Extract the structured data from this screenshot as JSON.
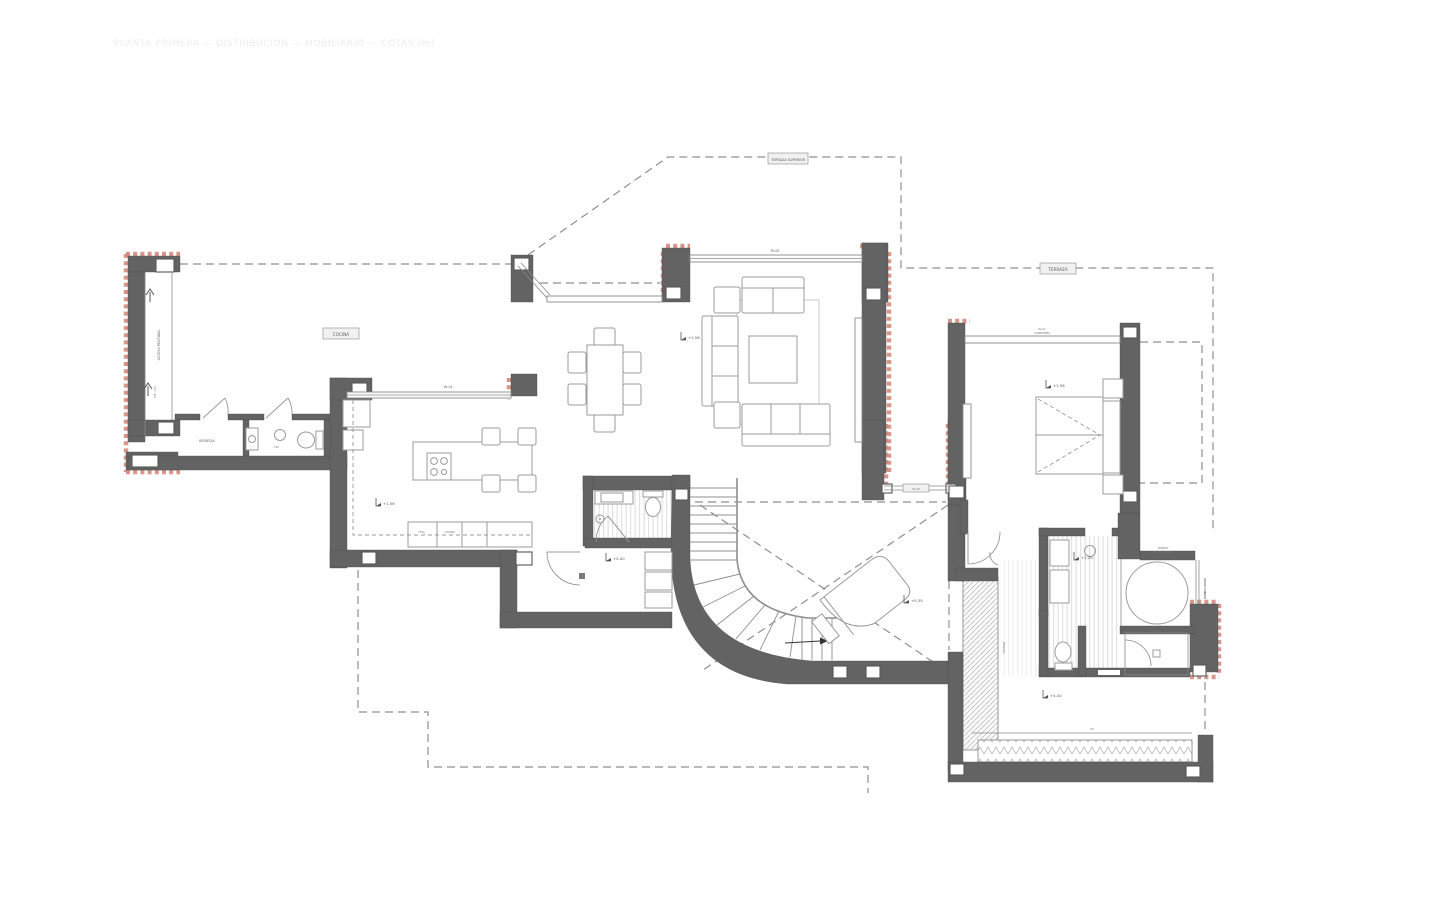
{
  "colors": {
    "background": "#ffffff",
    "wall": "#636363",
    "furniture_line": "#9b9b9b",
    "dashed_line": "#8f8f8f",
    "red_accent": "#d6897c",
    "floor_stripe": "#e2e2e2",
    "annotation_text": "#5a5a5a",
    "faint_text": "#ededed"
  },
  "annotations": {
    "faint_header": "PLANTA PRIMERA — DISTRIBUCIÓN — MOBILIARIO — COTAS (m)",
    "roof_label_top": "TERRAZA SUPERIOR",
    "roof_label_right": "TERRAZA",
    "kitchen_tag": "COCINA",
    "storage_label": "BODEGA",
    "laundry_dim": "1.90",
    "counter_cell_1": "FRIG.",
    "counter_cell_2": "HORNO",
    "kitchen_window_tag": "Va-04",
    "living_window_tag": "Pa-06",
    "bedroom_window_tag_line1": "Pa-07",
    "bedroom_window_tag_line2": "CORREDERA",
    "passage_tag": "Pa-08",
    "corridor_text": "ACCESO PEATONAL",
    "ramp_text": "PTE. 10%",
    "tub_label_line1": "BAÑERA",
    "tub_label_line2": "Ø1.70 EXENTA",
    "shower_label": "DUCHA",
    "slope_label": "3%",
    "glass_rail_text": "VIDRIO",
    "pergola_text": "PÉRGOLA"
  },
  "levels": {
    "kitchen": "+1.56",
    "living": "+1.58",
    "bedroom": "+1.56",
    "vanity": "+1.20",
    "closet": "+2.40",
    "stair_void": "+0.35",
    "terrace": "+4.40"
  }
}
